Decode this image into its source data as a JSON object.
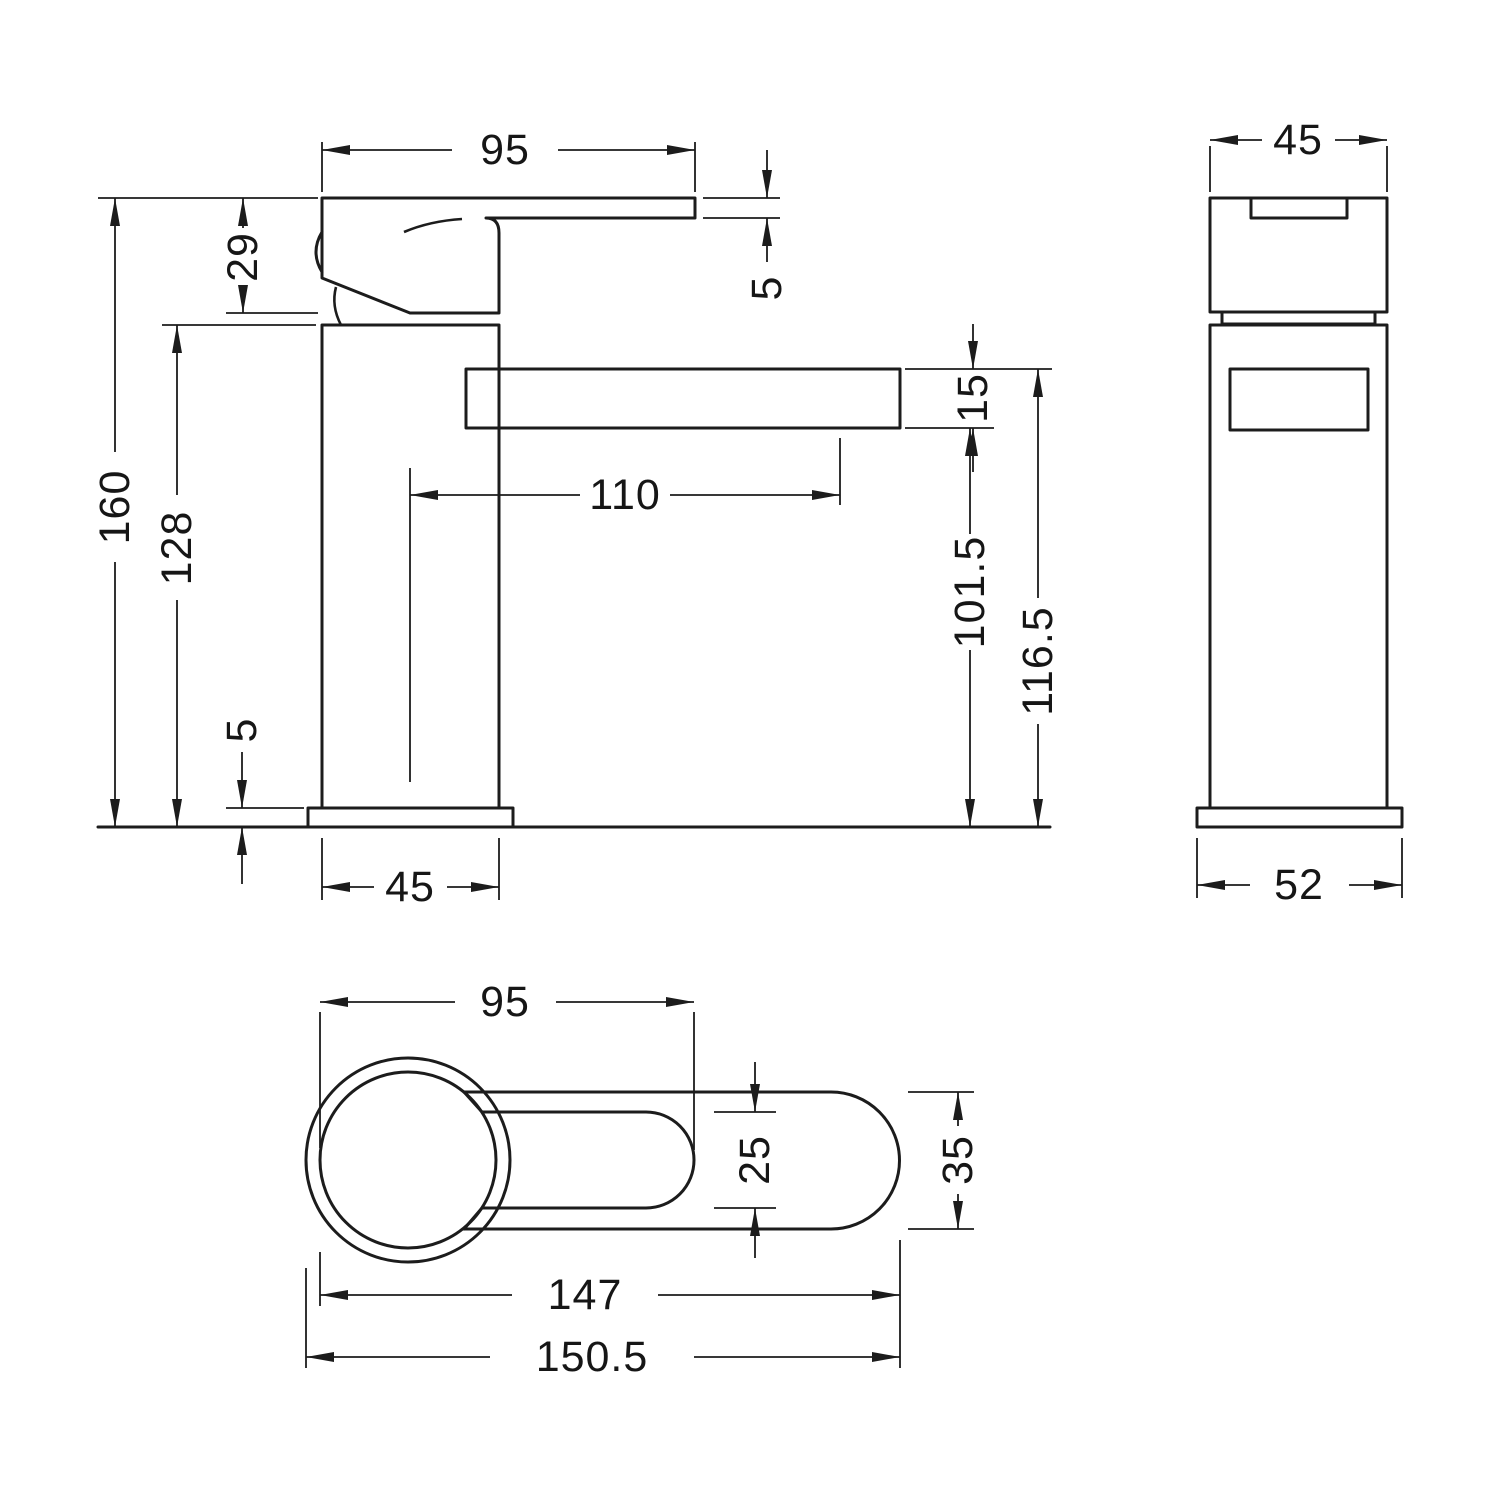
{
  "drawing": {
    "type": "technical-orthographic-drawing",
    "subject": "mono basin mixer tap",
    "line_color": "#1c1c1c",
    "background_color": "#ffffff",
    "units": "mm"
  },
  "views": {
    "side": {
      "label": "side-elevation",
      "dims": {
        "handle_reach": "95",
        "handle_height": "29",
        "lever_thickness": "5",
        "overall_height": "160",
        "body_height": "128",
        "spout_reach": "110",
        "spout_depth": "15",
        "spout_underside_height": "101.5",
        "spout_top_height": "116.5",
        "base_thickness": "5",
        "body_width": "45"
      }
    },
    "front": {
      "label": "front-elevation",
      "dims": {
        "body_width": "45",
        "base_width": "52"
      }
    },
    "top": {
      "label": "plan-view",
      "dims": {
        "handle_reach": "95",
        "lever_width": "25",
        "spout_width": "35",
        "length_to_body": "147",
        "overall_length": "150.5"
      }
    }
  }
}
